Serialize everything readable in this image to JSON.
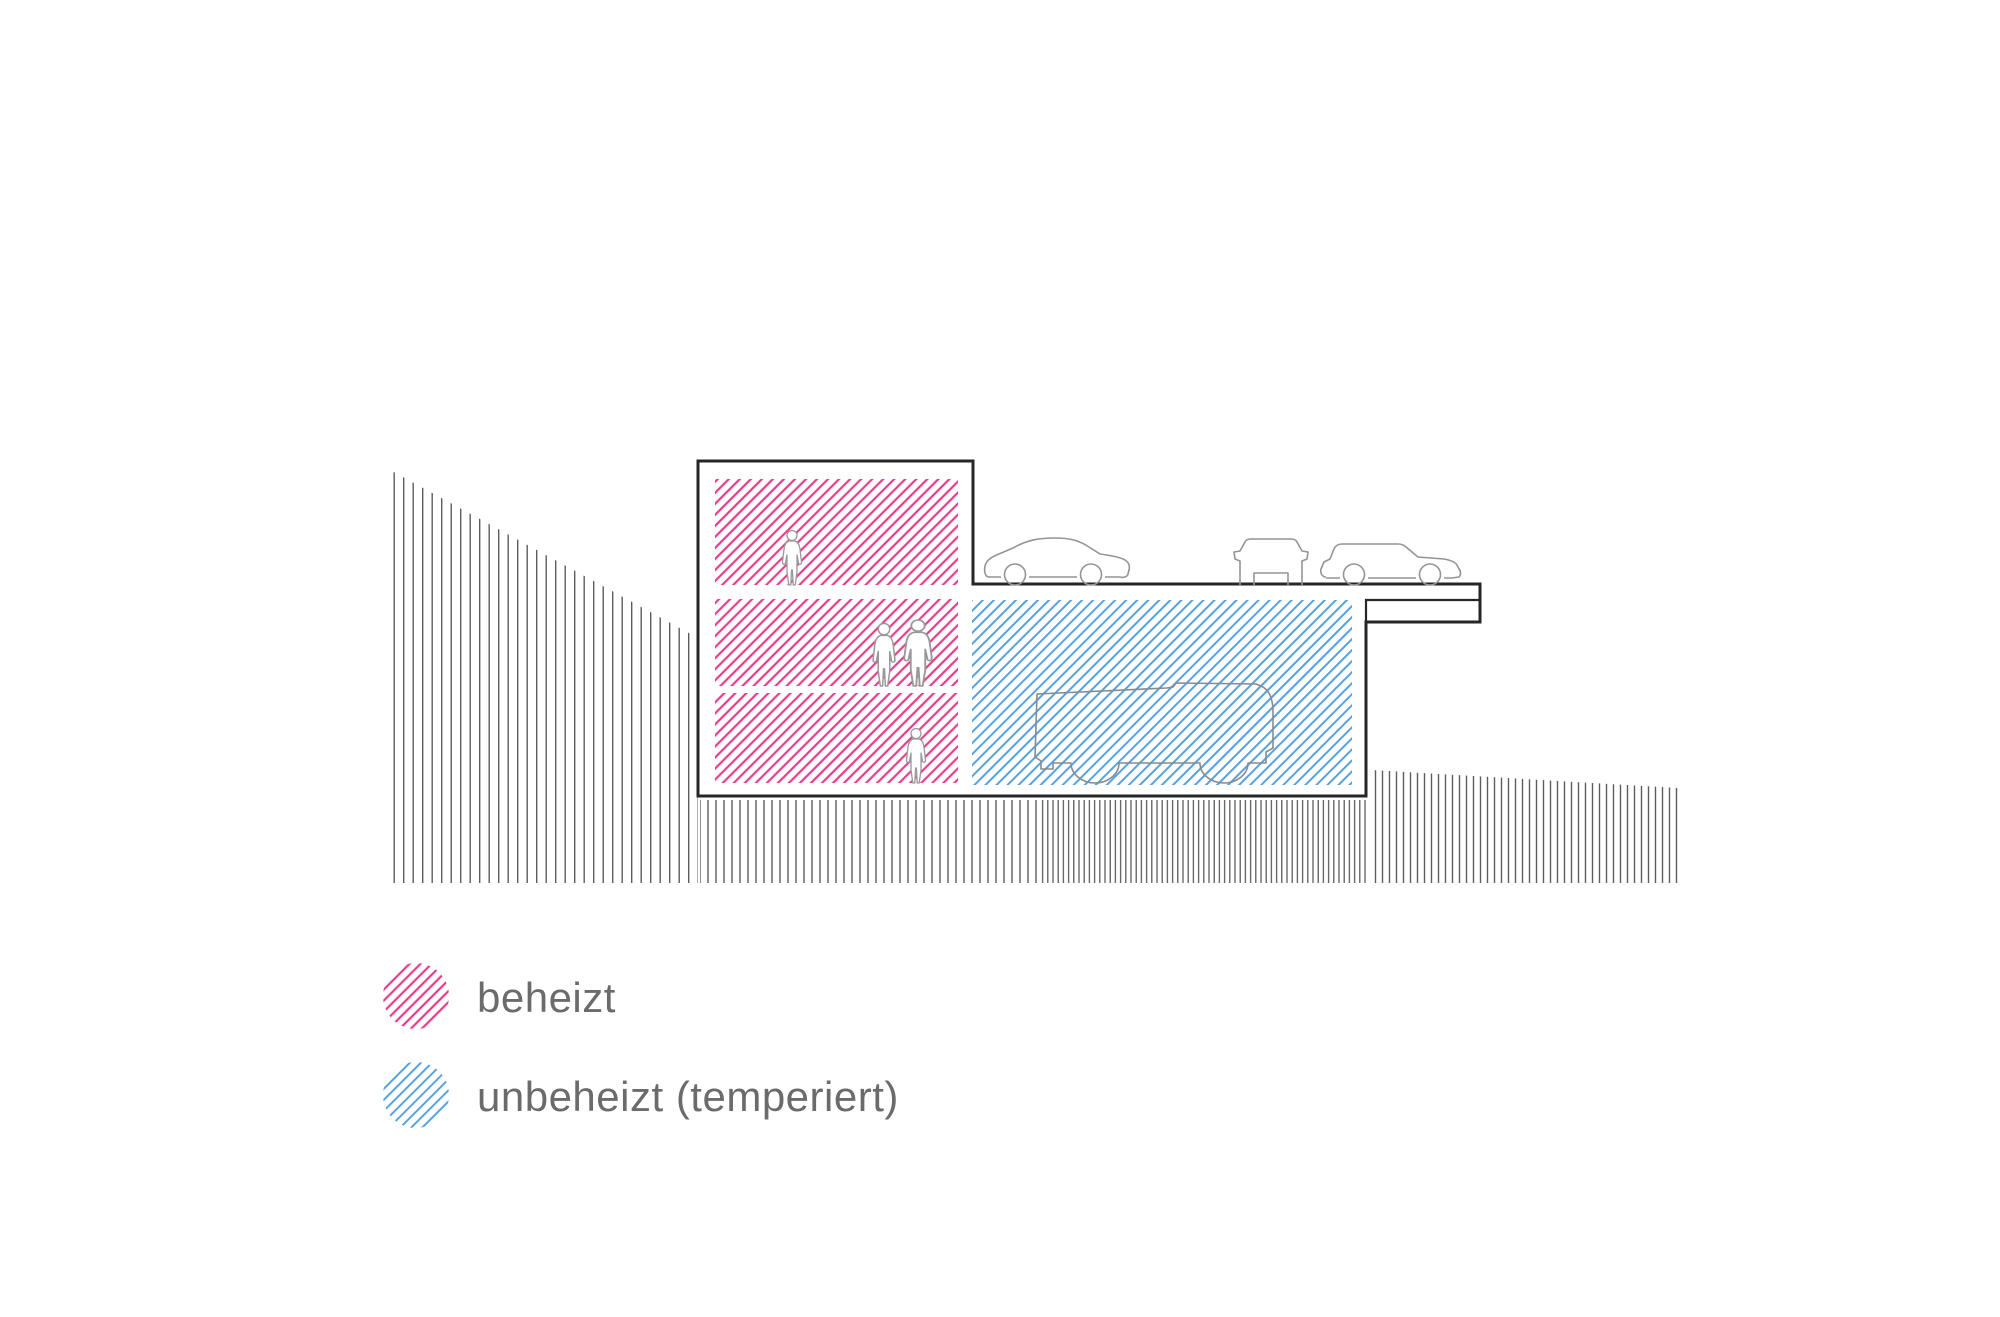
{
  "page": {
    "background": "#ffffff",
    "kind": "architectural cross-section diagram"
  },
  "legend": {
    "items": [
      {
        "id": "heated",
        "label": "beheizt",
        "swatch": "pink-hatch-circle",
        "color": "#e83c8c"
      },
      {
        "id": "unheated",
        "label": "unbeheizt (temperiert)",
        "swatch": "blue-hatch-circle",
        "color": "#55a1e2"
      }
    ]
  },
  "diagram": {
    "type": "building-section",
    "zones": [
      {
        "name": "heated-upper-floor",
        "hatch": "pink",
        "occupant_figures": 1
      },
      {
        "name": "heated-middle-floor",
        "hatch": "pink",
        "occupant_figures": 2
      },
      {
        "name": "heated-lower-floor",
        "hatch": "pink",
        "occupant_figures": 1
      },
      {
        "name": "unheated-parking-level",
        "hatch": "blue",
        "vehicle_figures": 1
      }
    ],
    "deck_vehicles": [
      "sedan-side-view",
      "car-front-view",
      "suv-side-view"
    ],
    "terrain": [
      "hillside-left",
      "ground-under-building",
      "ground-right"
    ],
    "colors": {
      "heated_hatch": "#e83c8c",
      "unheated_hatch": "#55a1e2",
      "building_outline": "#262626",
      "terrain_line": "#5c5c5c",
      "vehicle_outline": "#949494",
      "figure_outline": "#999999",
      "legend_text": "#6b6b6b"
    }
  }
}
